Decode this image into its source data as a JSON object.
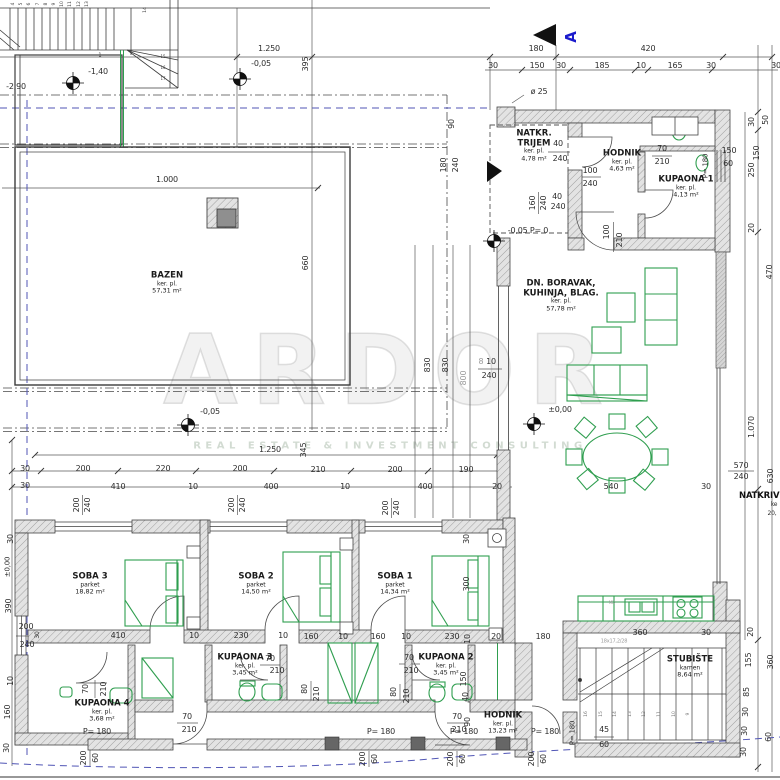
{
  "watermark": {
    "brand": "ARDOR",
    "tagline": "REAL ESTATE & INVESTMENT CONSULTING"
  },
  "section": {
    "label": "A"
  },
  "colors": {
    "furniture_green": "#2f9e4f",
    "section_blue": "#1a1acc",
    "boundary_blue": "#5055b5",
    "hatch_gray": "#dedede",
    "line_dark": "#3c3c3c"
  },
  "rooms": [
    {
      "name": "BAZEN",
      "finish": "ker. pl.",
      "area": "57,31 m²",
      "x": 167,
      "y": 283
    },
    {
      "name": "NATKR.",
      "name2": "TRIJEM",
      "finish": "ker. pl.",
      "area": "4,78 m²",
      "x": 534,
      "y": 146
    },
    {
      "name": "HODNIK",
      "finish": "ker. pl.",
      "area": "4,63 m²",
      "x": 622,
      "y": 161
    },
    {
      "name": "KUPAONA 1",
      "finish": "ker. pl.",
      "area": "4,13 m²",
      "x": 686,
      "y": 187
    },
    {
      "name": "DN. BORAVAK,",
      "name2": "KUHINJA, BLAG.",
      "finish": "ker. pl.",
      "area": "57,78 m²",
      "x": 561,
      "y": 296
    },
    {
      "name": "SOBA 3",
      "finish": "parket",
      "area": "18,82 m²",
      "x": 90,
      "y": 584
    },
    {
      "name": "SOBA 2",
      "finish": "parket",
      "area": "14,50 m²",
      "x": 256,
      "y": 584
    },
    {
      "name": "SOBA 1",
      "finish": "parket",
      "area": "14,34 m²",
      "x": 395,
      "y": 584
    },
    {
      "name": "KUPAONA 4",
      "finish": "ker. pl.",
      "area": "3,68 m²",
      "x": 102,
      "y": 711
    },
    {
      "name": "KUPAONA 3",
      "finish": "ker. pl.",
      "area": "3,45 m²",
      "x": 245,
      "y": 665
    },
    {
      "name": "KUPAONA 2",
      "finish": "ker. pl.",
      "area": "3,45 m²",
      "x": 446,
      "y": 665
    },
    {
      "name": "HODNIK",
      "finish": "ker. pl.",
      "area": "13,23 m²",
      "x": 503,
      "y": 723
    },
    {
      "name": "STUBIŠTE",
      "finish": "kamen",
      "area": "8,64 m²",
      "x": 690,
      "y": 667
    }
  ],
  "stairs": {
    "top_numbers": [
      "4",
      "5",
      "6",
      "7",
      "8",
      "9",
      "10",
      "11",
      "12",
      "13"
    ],
    "top_last": "14",
    "winders": [
      "15",
      "16",
      "17"
    ],
    "first": "1",
    "bottom_numbers": [
      "16",
      "15",
      "14",
      "13",
      "12",
      "11",
      "10",
      "9"
    ],
    "note": "18x17,2/28"
  },
  "dims": [
    {
      "t": "1.250",
      "x": 269,
      "y": 49
    },
    {
      "t": "-0,05",
      "x": 261,
      "y": 64
    },
    {
      "t": "395",
      "x": 306,
      "y": 64,
      "r": 1
    },
    {
      "t": "180",
      "x": 536,
      "y": 49
    },
    {
      "t": "420",
      "x": 648,
      "y": 49
    },
    {
      "t": "30",
      "x": 493,
      "y": 66
    },
    {
      "t": "150",
      "x": 537,
      "y": 66
    },
    {
      "t": "30",
      "x": 561,
      "y": 66
    },
    {
      "t": "185",
      "x": 602,
      "y": 66
    },
    {
      "t": "10",
      "x": 641,
      "y": 66
    },
    {
      "t": "165",
      "x": 675,
      "y": 66
    },
    {
      "t": "30",
      "x": 711,
      "y": 66
    },
    {
      "t": "30",
      "x": 776,
      "y": 66
    },
    {
      "t": "ø 25",
      "x": 539,
      "y": 92
    },
    {
      "t": "-1,40",
      "x": 98,
      "y": 72
    },
    {
      "t": "-2,90",
      "x": 16,
      "y": 87
    },
    {
      "t": "90",
      "x": 452,
      "y": 124,
      "r": 1
    },
    {
      "t": "180",
      "x": 444,
      "y": 165,
      "r": 1
    },
    {
      "t": "240",
      "x": 456,
      "y": 165,
      "r": 1
    },
    {
      "t": "1.000",
      "x": 167,
      "y": 180
    },
    {
      "t": "660",
      "x": 306,
      "y": 263,
      "r": 1
    },
    {
      "t": "40",
      "x": 558,
      "y": 144
    },
    {
      "t": "240",
      "x": 560,
      "y": 159
    },
    {
      "t": "100",
      "x": 590,
      "y": 171
    },
    {
      "t": "240",
      "x": 590,
      "y": 184
    },
    {
      "t": "160",
      "x": 533,
      "y": 203,
      "r": 1
    },
    {
      "t": "240",
      "x": 544,
      "y": 203,
      "r": 1
    },
    {
      "t": "40",
      "x": 557,
      "y": 197
    },
    {
      "t": "240",
      "x": 558,
      "y": 207
    },
    {
      "t": "70",
      "x": 662,
      "y": 149
    },
    {
      "t": "210",
      "x": 662,
      "y": 162
    },
    {
      "t": "P= 180",
      "x": 706,
      "y": 166,
      "r": 1,
      "s": 7
    },
    {
      "t": "150",
      "x": 729,
      "y": 151
    },
    {
      "t": "60",
      "x": 728,
      "y": 164
    },
    {
      "t": "-0,05 P= 0",
      "x": 528,
      "y": 231
    },
    {
      "t": "100",
      "x": 607,
      "y": 232,
      "r": 1
    },
    {
      "t": "210",
      "x": 620,
      "y": 240,
      "r": 1
    },
    {
      "t": "30",
      "x": 752,
      "y": 122,
      "r": 1
    },
    {
      "t": "50",
      "x": 766,
      "y": 120,
      "r": 1
    },
    {
      "t": "150",
      "x": 757,
      "y": 153,
      "r": 1
    },
    {
      "t": "250",
      "x": 752,
      "y": 170,
      "r": 1
    },
    {
      "t": "20",
      "x": 752,
      "y": 228,
      "r": 1
    },
    {
      "t": "470",
      "x": 770,
      "y": 272,
      "r": 1
    },
    {
      "t": "1.070",
      "x": 752,
      "y": 427,
      "r": 1
    },
    {
      "t": "630",
      "x": 771,
      "y": 476,
      "r": 1
    },
    {
      "t": "570",
      "x": 741,
      "y": 466
    },
    {
      "t": "240",
      "x": 741,
      "y": 477
    },
    {
      "t": "540",
      "x": 611,
      "y": 487
    },
    {
      "t": "30",
      "x": 706,
      "y": 487
    },
    {
      "t": "NATKRIVE",
      "x": 762,
      "y": 496,
      "b": 1
    },
    {
      "t": "ke",
      "x": 774,
      "y": 505,
      "s": 6
    },
    {
      "t": "20,",
      "x": 772,
      "y": 514,
      "s": 6
    },
    {
      "t": "20",
      "x": 751,
      "y": 632,
      "r": 1
    },
    {
      "t": "360",
      "x": 771,
      "y": 662,
      "r": 1
    },
    {
      "t": "155",
      "x": 749,
      "y": 660,
      "r": 1
    },
    {
      "t": "85",
      "x": 747,
      "y": 692,
      "r": 1
    },
    {
      "t": "30",
      "x": 746,
      "y": 712,
      "r": 1
    },
    {
      "t": "30",
      "x": 745,
      "y": 731,
      "r": 1
    },
    {
      "t": "30",
      "x": 744,
      "y": 752,
      "r": 1
    },
    {
      "t": "60",
      "x": 769,
      "y": 737,
      "r": 1
    },
    {
      "t": "±0,00",
      "x": 560,
      "y": 410
    },
    {
      "t": "830",
      "x": 428,
      "y": 365,
      "r": 1
    },
    {
      "t": "830",
      "x": 446,
      "y": 365,
      "r": 1
    },
    {
      "t": "800",
      "x": 464,
      "y": 378,
      "r": 1,
      "g": 1
    },
    {
      "t": "8",
      "x": 481,
      "y": 362,
      "g": 1
    },
    {
      "t": "10",
      "x": 491,
      "y": 362
    },
    {
      "t": "240",
      "x": 489,
      "y": 376
    },
    {
      "t": "-0,05",
      "x": 210,
      "y": 412
    },
    {
      "t": "1.250",
      "x": 270,
      "y": 450
    },
    {
      "t": "345",
      "x": 304,
      "y": 450,
      "r": 1
    },
    {
      "t": "30",
      "x": 25,
      "y": 469
    },
    {
      "t": "200",
      "x": 83,
      "y": 469
    },
    {
      "t": "220",
      "x": 163,
      "y": 469
    },
    {
      "t": "200",
      "x": 240,
      "y": 469
    },
    {
      "t": "210",
      "x": 318,
      "y": 470
    },
    {
      "t": "200",
      "x": 395,
      "y": 470
    },
    {
      "t": "190",
      "x": 466,
      "y": 470
    },
    {
      "t": "30",
      "x": 25,
      "y": 486
    },
    {
      "t": "410",
      "x": 118,
      "y": 487
    },
    {
      "t": "10",
      "x": 193,
      "y": 487
    },
    {
      "t": "400",
      "x": 271,
      "y": 487
    },
    {
      "t": "10",
      "x": 345,
      "y": 487
    },
    {
      "t": "400",
      "x": 425,
      "y": 487
    },
    {
      "t": "20",
      "x": 497,
      "y": 487
    },
    {
      "t": "200",
      "x": 77,
      "y": 505,
      "r": 1
    },
    {
      "t": "240",
      "x": 88,
      "y": 505,
      "r": 1
    },
    {
      "t": "200",
      "x": 232,
      "y": 505,
      "r": 1
    },
    {
      "t": "240",
      "x": 243,
      "y": 505,
      "r": 1
    },
    {
      "t": "200",
      "x": 386,
      "y": 508,
      "r": 1
    },
    {
      "t": "240",
      "x": 397,
      "y": 508,
      "r": 1
    },
    {
      "t": "30",
      "x": 467,
      "y": 539,
      "r": 1
    },
    {
      "t": "300",
      "x": 467,
      "y": 584,
      "r": 1
    },
    {
      "t": "30",
      "x": 11,
      "y": 539,
      "r": 1
    },
    {
      "t": "±0,00",
      "x": 8,
      "y": 567,
      "r": 1,
      "s": 7
    },
    {
      "t": "390",
      "x": 9,
      "y": 606,
      "r": 1
    },
    {
      "t": "200",
      "x": 26,
      "y": 627
    },
    {
      "t": "30",
      "x": 38,
      "y": 635,
      "r": 1,
      "s": 6
    },
    {
      "t": "240",
      "x": 27,
      "y": 645
    },
    {
      "t": "10",
      "x": 11,
      "y": 681,
      "r": 1
    },
    {
      "t": "160",
      "x": 8,
      "y": 712,
      "r": 1
    },
    {
      "t": "30",
      "x": 7,
      "y": 748,
      "r": 1
    },
    {
      "t": "410",
      "x": 118,
      "y": 636
    },
    {
      "t": "10",
      "x": 194,
      "y": 636
    },
    {
      "t": "230",
      "x": 241,
      "y": 636
    },
    {
      "t": "10",
      "x": 283,
      "y": 636
    },
    {
      "t": "160",
      "x": 311,
      "y": 637
    },
    {
      "t": "10",
      "x": 343,
      "y": 637
    },
    {
      "t": "160",
      "x": 378,
      "y": 637
    },
    {
      "t": "10",
      "x": 406,
      "y": 637
    },
    {
      "t": "230",
      "x": 452,
      "y": 637
    },
    {
      "t": "10",
      "x": 468,
      "y": 639,
      "r": 1
    },
    {
      "t": "20",
      "x": 496,
      "y": 637
    },
    {
      "t": "180",
      "x": 543,
      "y": 637
    },
    {
      "t": "360",
      "x": 640,
      "y": 633
    },
    {
      "t": "30",
      "x": 706,
      "y": 633
    },
    {
      "t": "70",
      "x": 270,
      "y": 659
    },
    {
      "t": "210",
      "x": 277,
      "y": 671
    },
    {
      "t": "70",
      "x": 409,
      "y": 658
    },
    {
      "t": "210",
      "x": 411,
      "y": 671
    },
    {
      "t": "70",
      "x": 86,
      "y": 689,
      "r": 1
    },
    {
      "t": "210",
      "x": 104,
      "y": 689,
      "r": 1
    },
    {
      "t": "80",
      "x": 305,
      "y": 689,
      "r": 1
    },
    {
      "t": "210",
      "x": 317,
      "y": 694,
      "r": 1
    },
    {
      "t": "80",
      "x": 394,
      "y": 692,
      "r": 1
    },
    {
      "t": "210",
      "x": 407,
      "y": 696,
      "r": 1
    },
    {
      "t": "150",
      "x": 464,
      "y": 679,
      "r": 1
    },
    {
      "t": "40",
      "x": 466,
      "y": 697,
      "r": 1
    },
    {
      "t": "90",
      "x": 468,
      "y": 722,
      "r": 1
    },
    {
      "t": "70",
      "x": 187,
      "y": 717
    },
    {
      "t": "210",
      "x": 189,
      "y": 730
    },
    {
      "t": "70",
      "x": 457,
      "y": 717
    },
    {
      "t": "210",
      "x": 459,
      "y": 730
    },
    {
      "t": "P= 180",
      "x": 97,
      "y": 732
    },
    {
      "t": "P= 180",
      "x": 381,
      "y": 732
    },
    {
      "t": "P= 180",
      "x": 464,
      "y": 732
    },
    {
      "t": "P= 180",
      "x": 545,
      "y": 732
    },
    {
      "t": "P= 180",
      "x": 573,
      "y": 733,
      "r": 1,
      "s": 7
    },
    {
      "t": "45",
      "x": 604,
      "y": 730
    },
    {
      "t": "60",
      "x": 604,
      "y": 745
    },
    {
      "t": "200",
      "x": 84,
      "y": 758,
      "r": 1
    },
    {
      "t": "60",
      "x": 96,
      "y": 758,
      "r": 1
    },
    {
      "t": "200",
      "x": 363,
      "y": 759,
      "r": 1
    },
    {
      "t": "60",
      "x": 375,
      "y": 759,
      "r": 1
    },
    {
      "t": "200",
      "x": 451,
      "y": 759,
      "r": 1
    },
    {
      "t": "60",
      "x": 463,
      "y": 759,
      "r": 1
    },
    {
      "t": "200",
      "x": 532,
      "y": 759,
      "r": 1
    },
    {
      "t": "60",
      "x": 544,
      "y": 759,
      "r": 1
    },
    {
      "t": "18x17,2/28",
      "x": 614,
      "y": 642,
      "s": 5,
      "g": 1
    },
    {
      "t": "MD",
      "x": 612,
      "y": 603,
      "s": 4,
      "g": 1
    }
  ]
}
